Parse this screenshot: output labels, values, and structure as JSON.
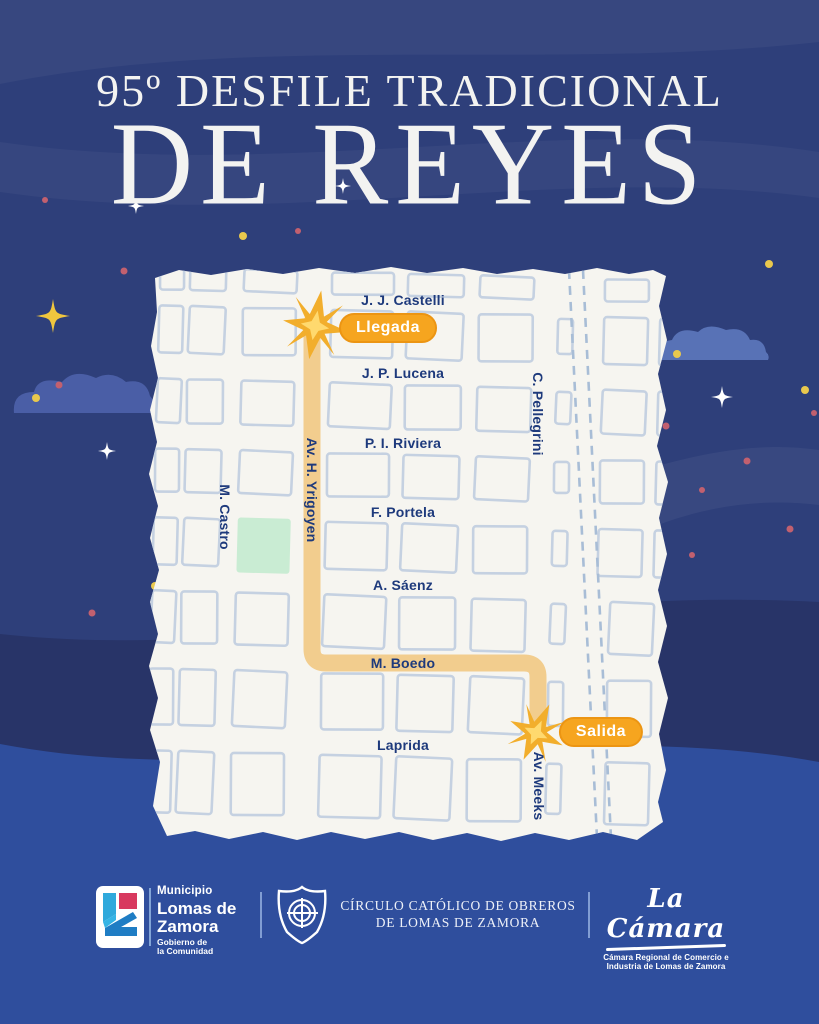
{
  "poster": {
    "title_line1": "95º DESFILE TRADICIONAL",
    "title_line2": "DE REYES"
  },
  "map": {
    "arrival_badge": "Llegada",
    "departure_badge": "Salida",
    "streets": {
      "castelli": "J. J. Castelli",
      "lucena": "J. P. Lucena",
      "riviera": "P. I. Riviera",
      "portela": "F. Portela",
      "saenz": "A. Sáenz",
      "boedo": "M. Boedo",
      "laprida": "Laprida",
      "castro": "M. Castro",
      "yrigoyen": "Av. H. Yrigoyen",
      "pellegrini": "C. Pellegrini",
      "meeks": "Av. Meeks"
    },
    "route_description": "Av. H. Yrigoyen desde J. J. Castelli (Llegada) hasta M. Boedo, por M. Boedo hasta Av. Meeks, por Av. Meeks hasta Laprida (Salida)"
  },
  "footer": {
    "municipio": {
      "line1": "Municipio",
      "line2": "Lomas de",
      "line3": "Zamora",
      "sub1": "Gobierno de",
      "sub2": "la Comunidad"
    },
    "circulo": {
      "line1": "CÍRCULO CATÓLICO DE OBREROS",
      "line2": "DE LOMAS DE ZAMORA"
    },
    "camara": {
      "script": "La Cámara",
      "sub1": "Cámara Regional de Comercio e",
      "sub2": "Industria de Lomas de Zamora"
    }
  },
  "colors": {
    "night_blue": "#2e3f7a",
    "deep_band": "#283468",
    "bottom_wave": "#2f4e9d",
    "paper": "#f6f5f0",
    "block_stroke": "#c5d1e1",
    "street_text": "#1e3a7c",
    "route_yellow": "#f2cd8e",
    "badge_orange": "#f6a51f",
    "star_gold": "#f2b231",
    "plaza_green": "#c9ecd3",
    "cloud_blue": "#4a5ea6"
  }
}
